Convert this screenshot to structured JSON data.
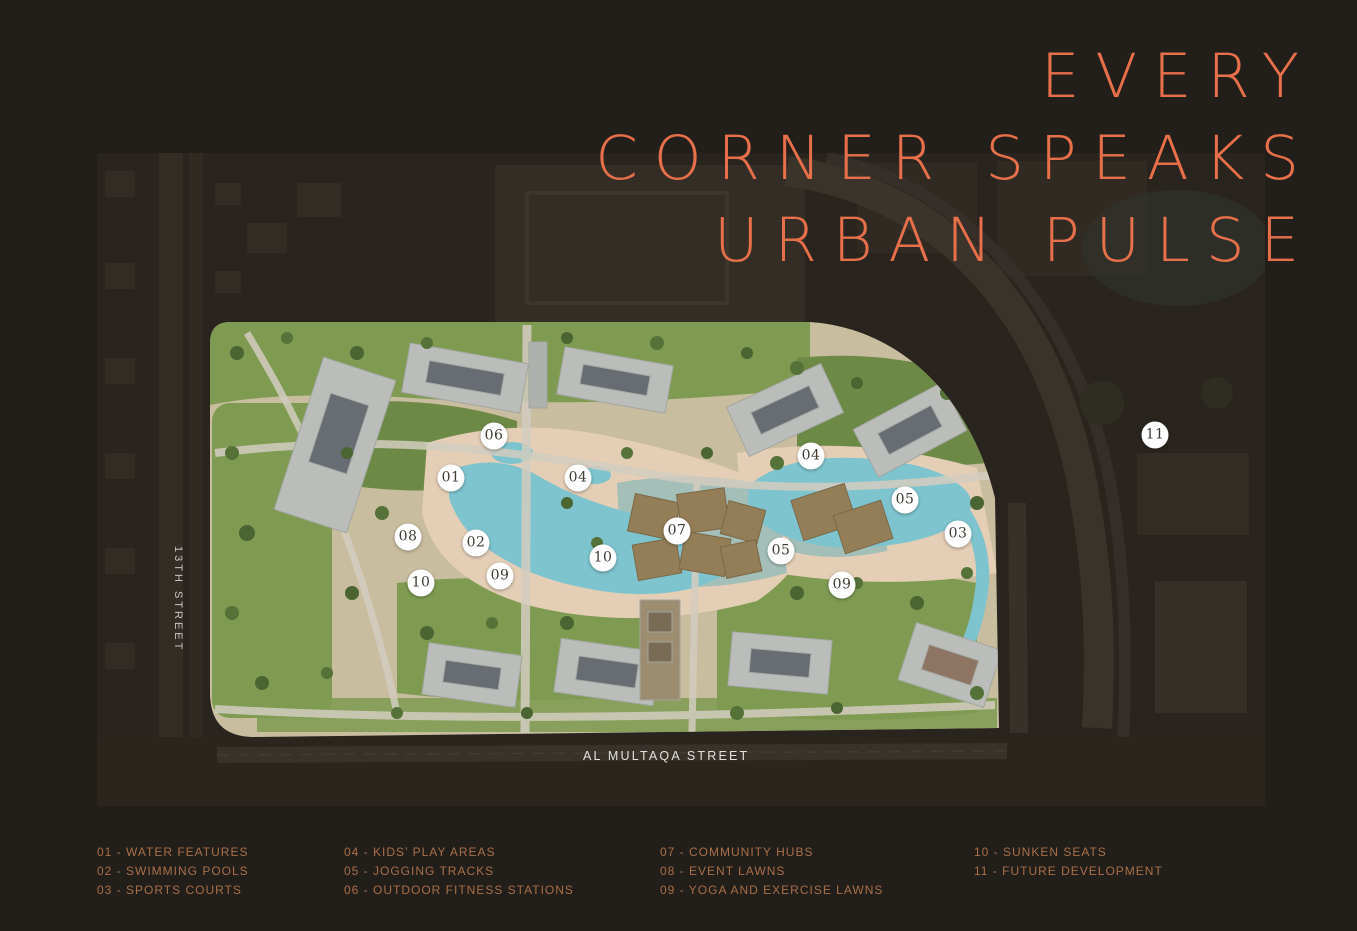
{
  "title": {
    "lines": [
      "EVERY",
      "CORNER SPEAKS",
      "URBAN PULSE"
    ],
    "color": "#E7704A"
  },
  "map": {
    "streets": {
      "left_vertical": "13TH STREET",
      "bottom_horizontal": "AL MULTAQA STREET"
    },
    "markers": [
      {
        "label": "06",
        "x": 494,
        "y": 436
      },
      {
        "label": "01",
        "x": 451,
        "y": 478
      },
      {
        "label": "04",
        "x": 578,
        "y": 478
      },
      {
        "label": "04",
        "x": 811,
        "y": 456
      },
      {
        "label": "05",
        "x": 905,
        "y": 500
      },
      {
        "label": "07",
        "x": 677,
        "y": 531
      },
      {
        "label": "03",
        "x": 958,
        "y": 534
      },
      {
        "label": "08",
        "x": 408,
        "y": 537
      },
      {
        "label": "02",
        "x": 476,
        "y": 543
      },
      {
        "label": "05",
        "x": 781,
        "y": 551
      },
      {
        "label": "10",
        "x": 603,
        "y": 558
      },
      {
        "label": "09",
        "x": 500,
        "y": 576
      },
      {
        "label": "10",
        "x": 421,
        "y": 583
      },
      {
        "label": "09",
        "x": 842,
        "y": 585
      },
      {
        "label": "11",
        "x": 1155,
        "y": 435
      }
    ]
  },
  "legend": {
    "columns": [
      [
        {
          "num": "01",
          "label": "WATER FEATURES"
        },
        {
          "num": "02",
          "label": "SWIMMING POOLS"
        },
        {
          "num": "03",
          "label": "SPORTS COURTS"
        }
      ],
      [
        {
          "num": "04",
          "label": "KIDS’ PLAY AREAS"
        },
        {
          "num": "05",
          "label": "JOGGING TRACKS"
        },
        {
          "num": "06",
          "label": "OUTDOOR FITNESS STATIONS"
        }
      ],
      [
        {
          "num": "07",
          "label": "COMMUNITY HUBS"
        },
        {
          "num": "08",
          "label": "EVENT LAWNS"
        },
        {
          "num": "09",
          "label": "YOGA AND EXERCISE LAWNS"
        }
      ],
      [
        {
          "num": "10",
          "label": "SUNKEN SEATS"
        },
        {
          "num": "11",
          "label": "FUTURE DEVELOPMENT"
        }
      ]
    ],
    "separator": " - ",
    "color": "#A96F48"
  },
  "colors": {
    "background": "#221E1A",
    "title_accent": "#E7704A",
    "legend_text": "#A96F48",
    "marker_fill": "#FFFFFF",
    "marker_text": "#3F3B33",
    "street_label": "#C8C6C1"
  }
}
